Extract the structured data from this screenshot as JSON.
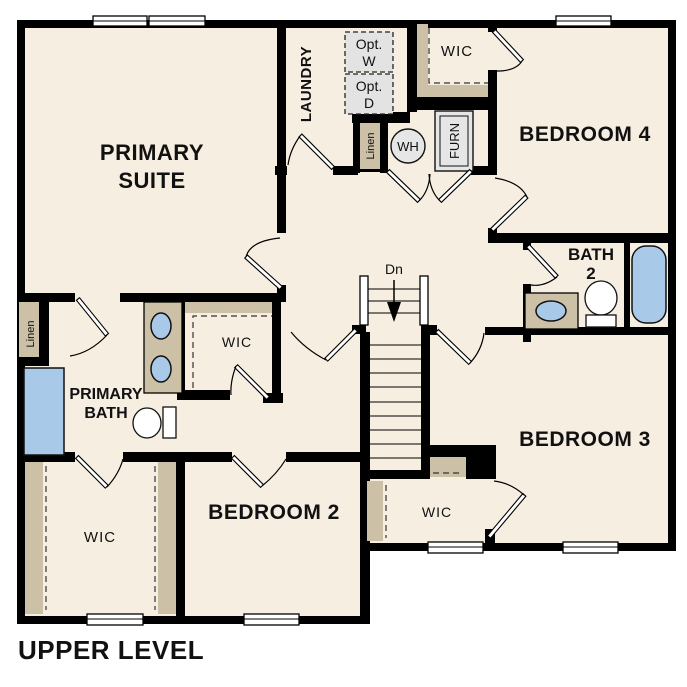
{
  "title": "UPPER LEVEL",
  "colors": {
    "background": "#ffffff",
    "floor": "#f6eee1",
    "wall": "#000000",
    "casework": "#ccc0a6",
    "fixture_blue": "#a9c9e9",
    "equipment_gray": "#e3e3e3",
    "text": "#111111"
  },
  "rooms": {
    "primary_suite": {
      "line1": "PRIMARY",
      "line2": "SUITE"
    },
    "laundry": {
      "label": "LAUNDRY"
    },
    "wic_top": {
      "label": "WIC"
    },
    "bedroom4": {
      "label": "BEDROOM 4"
    },
    "bath2": {
      "line1": "BATH",
      "line2": "2"
    },
    "primary_bath": {
      "line1": "PRIMARY",
      "line2": "BATH"
    },
    "wic_mid": {
      "label": "WIC"
    },
    "wic_lower_left": {
      "label": "WIC"
    },
    "bedroom2": {
      "label": "BEDROOM 2"
    },
    "wic_lower_right": {
      "label": "WIC"
    },
    "bedroom3": {
      "label": "BEDROOM 3"
    }
  },
  "closets": {
    "linen_left": "Linen",
    "linen_hall": "Linen"
  },
  "equipment": {
    "opt_washer_line1": "Opt.",
    "opt_washer_line2": "W",
    "opt_dryer_line1": "Opt.",
    "opt_dryer_line2": "D",
    "water_heater": "WH",
    "furnace": "FURN"
  },
  "stairs": {
    "down_label": "Dn"
  }
}
